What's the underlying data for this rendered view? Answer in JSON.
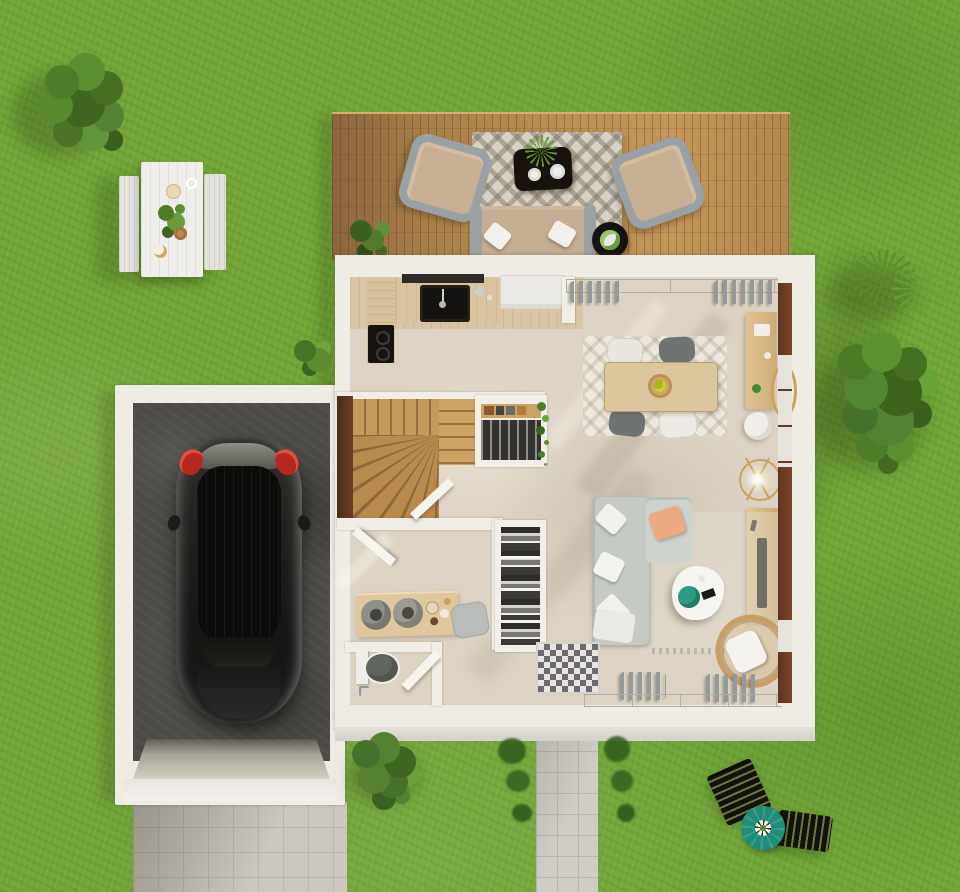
{
  "scene": {
    "kind": "3d-floor-plan-render",
    "view": "top-down",
    "description": "Photorealistic top-down render of a house ground floor with attached garage, wooden terrace, garden furniture and lawn"
  },
  "palette": {
    "grass": "#72a437",
    "deck_wood": "#b28851",
    "house_wall": "#efece6",
    "interior_floor": "#ddd3c4",
    "kitchen_wood_floor": "#d8c6a6",
    "stair_wood": "#b9894e",
    "frame_brown": "#6b3a22",
    "garage_floor": "#4c4b47",
    "paving_gray": "#cdc9c2",
    "car_black": "#1b1a18",
    "taillight_red": "#b5281f",
    "parasol_teal": "#1e8d77",
    "peach_pillow": "#eeab82",
    "plant_teal": "#2e9a84",
    "gold_accent": "#c9a35c",
    "rattan": "#c59f63",
    "sofa_gray": "#c6cac5",
    "outdoor_cushion_tan": "#c4ad92"
  },
  "outdoor": {
    "lawn": {
      "label": "lawn"
    },
    "picnic_set": {
      "label": "garden picnic table with two benches, plant and breakfast plates"
    },
    "terrace": {
      "label": "wooden terrace with rug, coffee table, two armchairs, sofa and side table"
    },
    "sun_corner": {
      "label": "two black sun loungers with teal parasol"
    },
    "walkway": {
      "label": "tiled walkway to entrance"
    },
    "driveway": {
      "label": "tiled driveway below garage"
    },
    "plants": {
      "bush_top_left": "large bush",
      "tree_right": "leafy tree",
      "grass_plant_right": "ornamental grass",
      "bush_bottom": "garden bush",
      "walkway_shrubs": "row of small shrubs"
    }
  },
  "house": {
    "label": "house ground floor",
    "rooms": [
      {
        "name": "kitchen",
        "furniture": [
          "worktop with black sink",
          "cooktop",
          "tall white cabinet"
        ]
      },
      {
        "name": "dining-area",
        "furniture": [
          "wooden dining table",
          "four chairs",
          "light rug",
          "sideboard",
          "round gold mirror",
          "white pouf",
          "curtained glass wall"
        ]
      },
      {
        "name": "living-area",
        "furniture": [
          "gray corner sofa",
          "organic white coffee table",
          "rattan armchair",
          "tv sideboard",
          "gold floor lamp",
          "rug",
          "patterned entry tiles"
        ]
      },
      {
        "name": "staircase",
        "furniture": [
          "wooden winder stairs",
          "glazed wardrobe with clothes",
          "hanging plant"
        ]
      },
      {
        "name": "utility-room",
        "furniture": [
          "wooden work table",
          "two gray baskets",
          "gray chair",
          "open doors"
        ]
      },
      {
        "name": "wc",
        "furniture": [
          "toilet"
        ]
      },
      {
        "name": "wardrobe",
        "furniture": [
          "shelves with folded clothes"
        ]
      }
    ]
  },
  "garage": {
    "label": "garage",
    "contents": [
      "black hatchback car seen from above"
    ]
  }
}
